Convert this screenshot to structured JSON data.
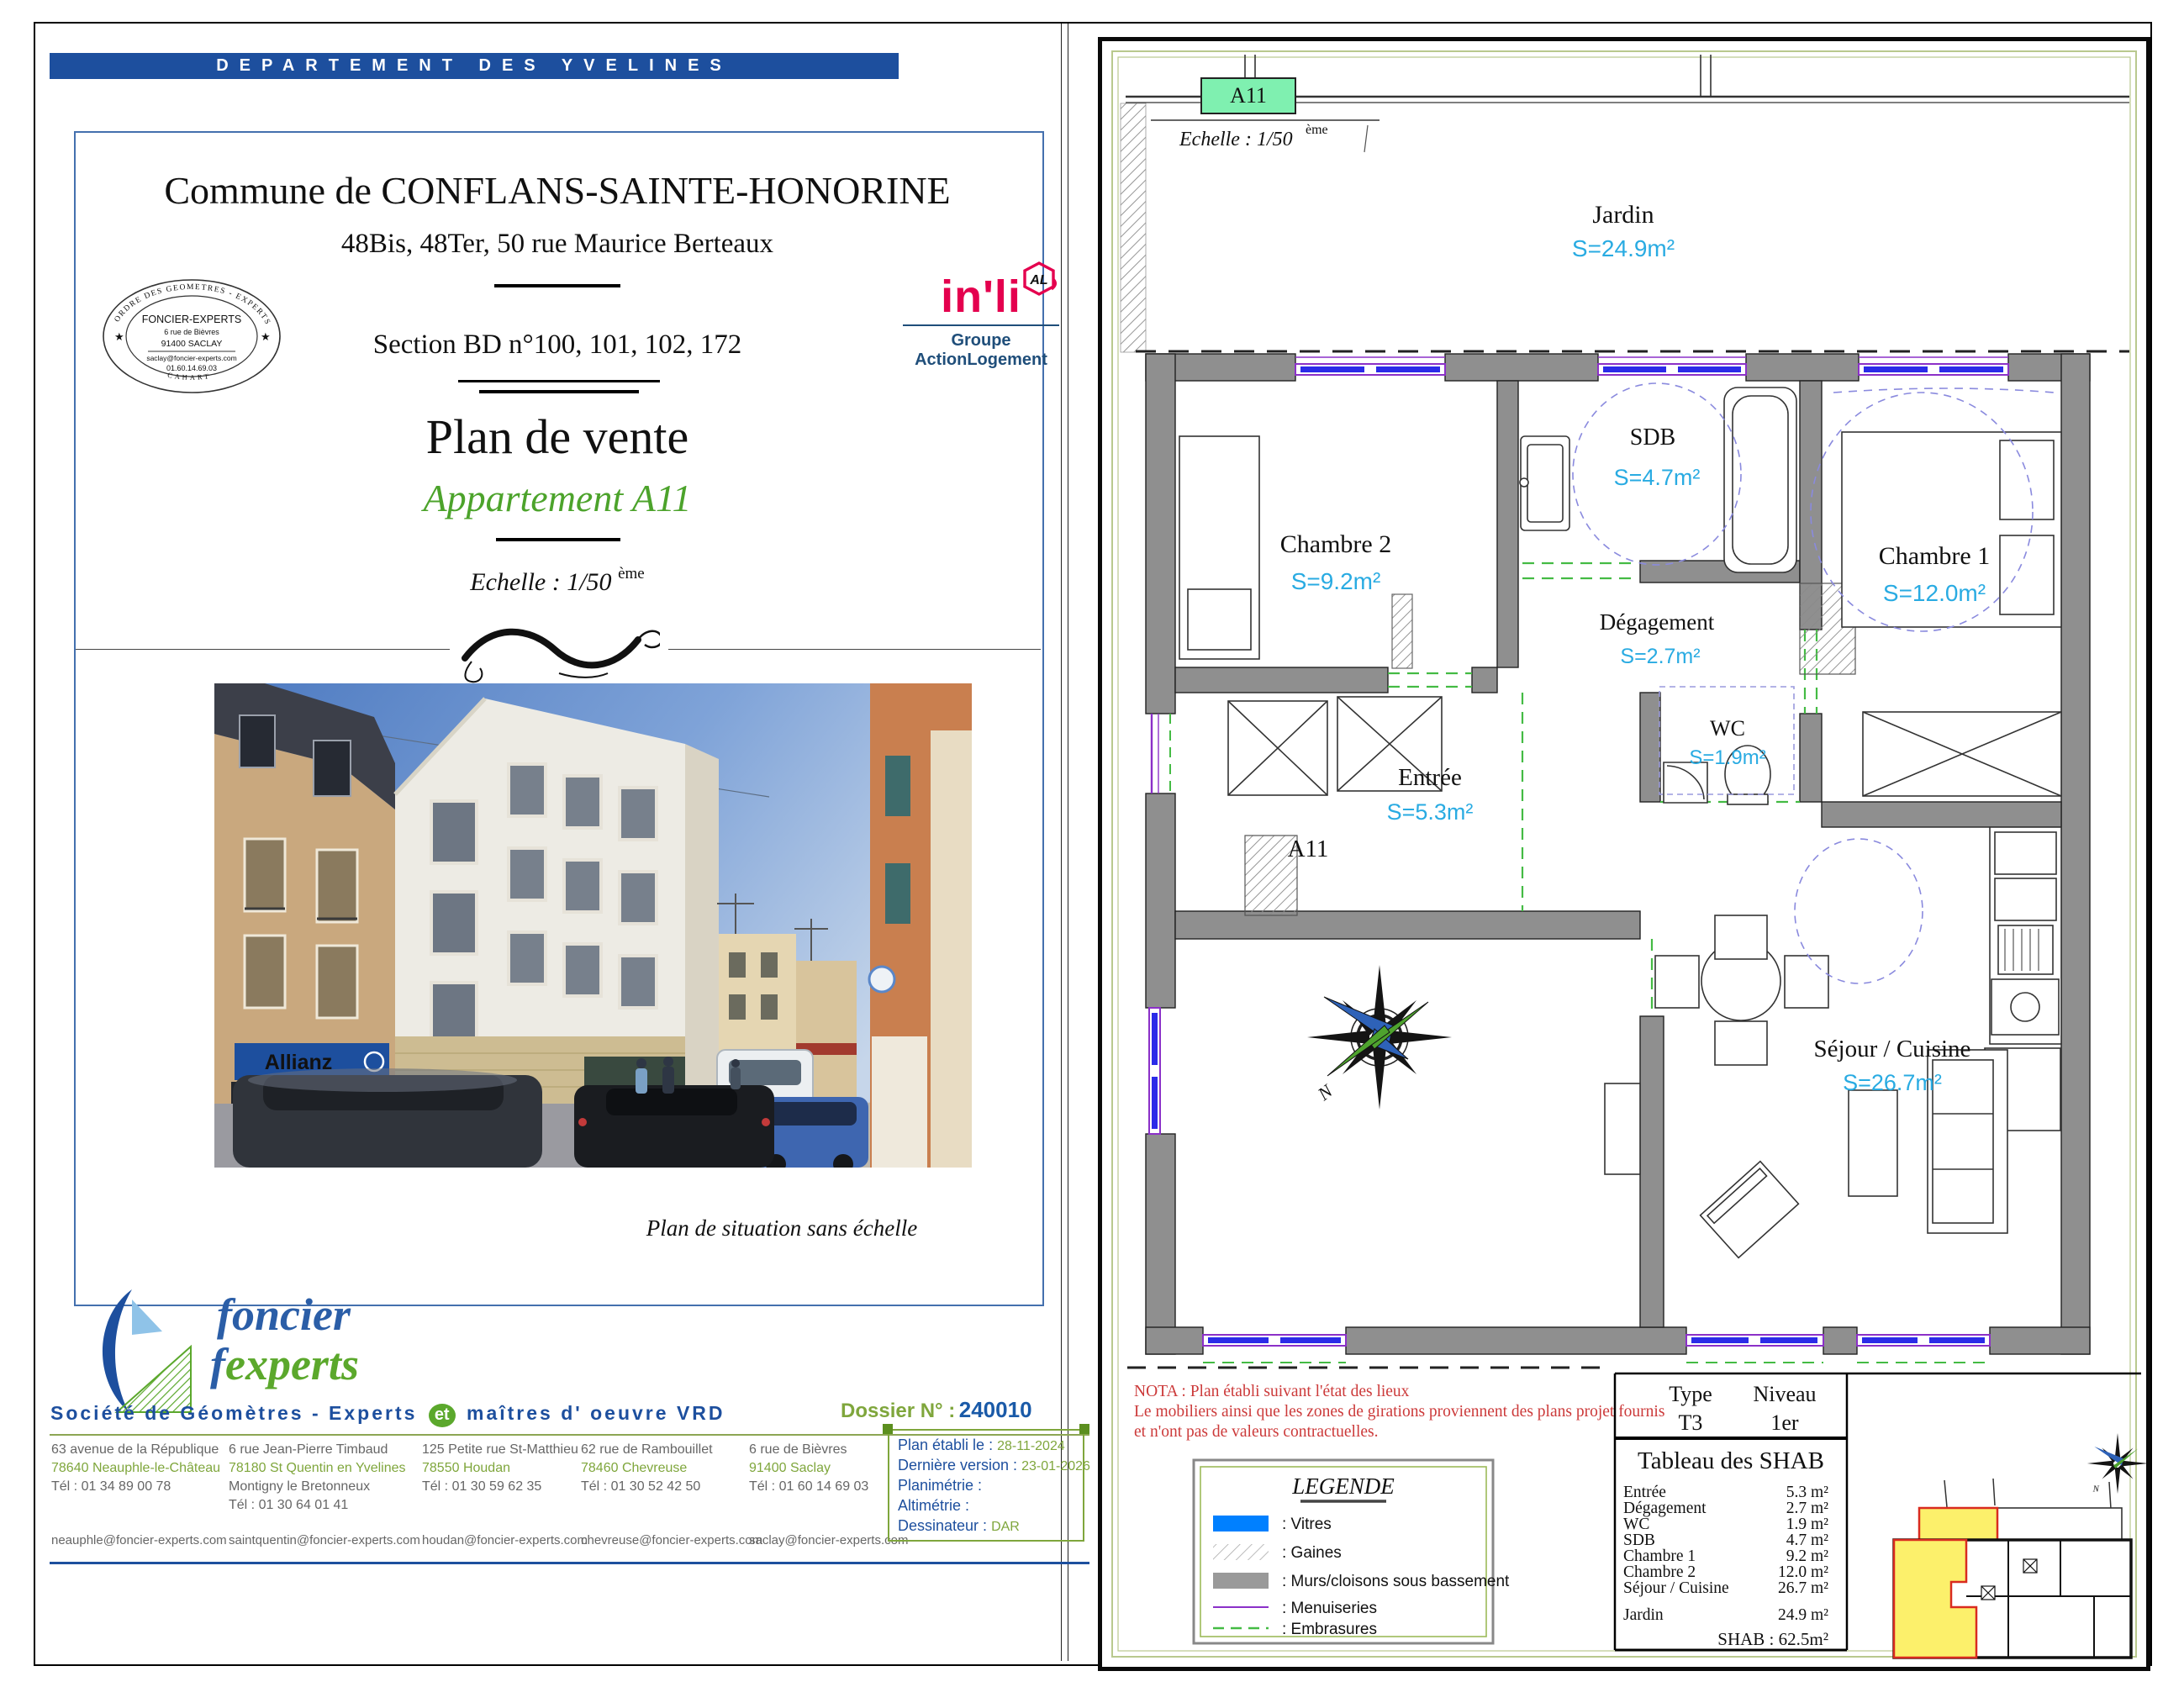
{
  "header": {
    "banner": "DEPARTEMENT DES YVELINES"
  },
  "title_block": {
    "commune": "Commune de CONFLANS-SAINTE-HONORINE",
    "address": "48Bis, 48Ter, 50 rue Maurice Berteaux",
    "section": "Section BD n°100, 101, 102, 172",
    "plan_title": "Plan de vente",
    "apartment": "Appartement A11",
    "scale_label": "Echelle : 1/50",
    "scale_sup": "ème"
  },
  "stamp": {
    "ring_top": "ORDRE DES GEOMETRES - EXPERTS",
    "name": "FONCIER-EXPERTS",
    "addr1": "6 rue de Bièvres",
    "addr2": "91400 SACLAY",
    "email": "saclay@foncier-experts.com",
    "phone": "01.60.14.69.03",
    "ring_bottom": "CAHART"
  },
  "inli": {
    "brand": "in'li",
    "badge": "AL",
    "group": "Groupe ActionLogement"
  },
  "photo": {
    "allianz": "Allianz",
    "caption": "Plan de situation sans échelle"
  },
  "foncier": {
    "word1": "foncier",
    "f": "f",
    "word2": "experts",
    "tagline_left": "Société de Géomètres - Experts",
    "tagline_et": "et",
    "tagline_right": "maîtres d' oeuvre VRD"
  },
  "agencies": [
    {
      "lines": [
        "63 avenue de la République",
        "78640 Neauphle-le-Château",
        "Tél : 01 34 89 00 78"
      ],
      "email": "neauphle@foncier-experts.com"
    },
    {
      "lines": [
        "6 rue Jean-Pierre Timbaud",
        "78180  St Quentin en Yvelines",
        "Montigny le Bretonneux",
        "Tél :  01 30 64 01 41"
      ],
      "email": "saintquentin@foncier-experts.com"
    },
    {
      "lines": [
        "125 Petite rue St-Matthieu",
        "78550  Houdan",
        "Tél : 01 30 59 62 35"
      ],
      "email": "houdan@foncier-experts.com"
    },
    {
      "lines": [
        "62 rue de Rambouillet",
        "78460 Chevreuse",
        "Tél : 01 30 52 42 50"
      ],
      "email": "chevreuse@foncier-experts.com"
    },
    {
      "lines": [
        "6 rue de Bièvres",
        "91400  Saclay",
        "Tél : 01 60 14 69 03"
      ],
      "email": "saclay@foncier-experts.com"
    }
  ],
  "dossier": {
    "label": "Dossier N° :",
    "number": "240010",
    "fields": [
      {
        "label": "Plan établi le :",
        "value": "28-11-2024"
      },
      {
        "label": "Dernière version :",
        "value": "23-01-2026"
      },
      {
        "label": "Planimétrie :",
        "value": ""
      },
      {
        "label": "Altimétrie :",
        "value": ""
      },
      {
        "label": "Dessinateur :",
        "value": "DAR"
      }
    ]
  },
  "plan": {
    "badge": "A11",
    "scale_label": "Echelle : 1/50",
    "scale_sup": "ème",
    "unit_label": "A11",
    "north": "N",
    "rooms": [
      {
        "name": "Jardin",
        "area": "S=24.9m²"
      },
      {
        "name": "Chambre 2",
        "area": "S=9.2m²"
      },
      {
        "name": "SDB",
        "area": "S=4.7m²"
      },
      {
        "name": "Chambre 1",
        "area": "S=12.0m²"
      },
      {
        "name": "Dégagement",
        "area": "S=2.7m²"
      },
      {
        "name": "WC",
        "area": "S=1.9m²"
      },
      {
        "name": "Entrée",
        "area": "S=5.3m²"
      },
      {
        "name": "Séjour / Cuisine",
        "area": "S=26.7m²"
      }
    ],
    "nota": [
      "NOTA : Plan établi suivant l'état des lieux",
      "Le mobiliers ainsi que les zones de girations proviennent des plans projet fournis",
      "et n'ont pas de valeurs contractuelles."
    ]
  },
  "legend": {
    "title": "LEGENDE",
    "items": [
      ": Vitres",
      ": Gaines",
      ": Murs/cloisons sous bassement",
      ": Menuiseries",
      ": Embrasures"
    ]
  },
  "type_table": {
    "type_label": "Type",
    "type_value": "T3",
    "level_label": "Niveau",
    "level_value": "1er"
  },
  "shab": {
    "title": "Tableau des SHAB",
    "rows": [
      [
        "Entrée",
        "5.3 m²"
      ],
      [
        "Dégagement",
        "2.7 m²"
      ],
      [
        "WC",
        "1.9 m²"
      ],
      [
        "SDB",
        "4.7 m²"
      ],
      [
        "Chambre 1",
        "9.2 m²"
      ],
      [
        "Chambre 2",
        "12.0 m²"
      ],
      [
        "Séjour / Cuisine",
        "26.7 m²"
      ],
      [
        "Jardin",
        "24.9 m²"
      ]
    ],
    "total": "SHAB : 62.5m²"
  },
  "colors": {
    "banner_blue": "#1D4F9E",
    "accent_green": "#4CA32B",
    "olive_green": "#7FA63C",
    "area_cyan": "#29ABE2",
    "inli_pink": "#E4004E",
    "nota_red": "#CC3A3A",
    "vitres_blue": "#0080FF",
    "menuiserie_purple": "#8B30C8",
    "embrasure_green": "#44BB44",
    "wall_gray": "#8F8F8F",
    "badge_mint": "#7FF0B0",
    "keyplan_yellow": "#FCF06B"
  }
}
